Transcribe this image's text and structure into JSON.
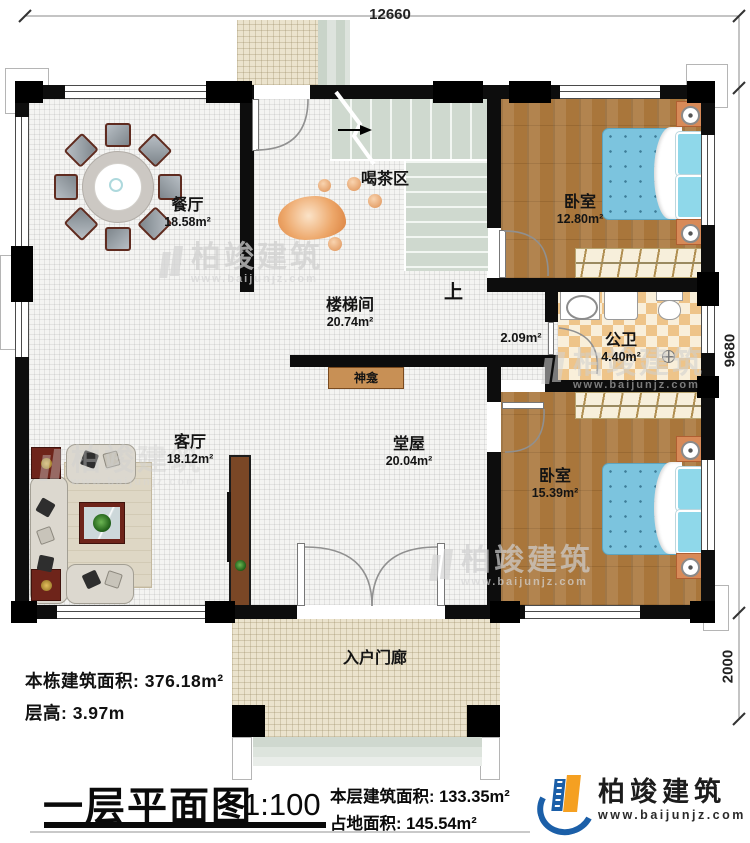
{
  "dimensions": {
    "top_width": "12660",
    "main_depth": "9680",
    "porch_depth": "2000"
  },
  "rooms": {
    "dining": {
      "label": "餐厅",
      "area": "18.58m²"
    },
    "tea_area": {
      "label": "喝茶区"
    },
    "stairwell": {
      "label": "楼梯间",
      "area": "20.74m²"
    },
    "stairs_up": {
      "label": "上"
    },
    "corridor": {
      "area": "2.09m²"
    },
    "bedroom_top": {
      "label": "卧室",
      "area": "12.80m²"
    },
    "bathroom": {
      "label": "公卫",
      "area": "4.40m²"
    },
    "living": {
      "label": "客厅",
      "area": "18.12m²"
    },
    "hall": {
      "label": "堂屋",
      "area": "20.04m²"
    },
    "shrine": {
      "label": "神龛"
    },
    "bedroom_bottom": {
      "label": "卧室",
      "area": "15.39m²"
    },
    "porch": {
      "label": "入户门廊"
    }
  },
  "notes": {
    "building_area": "本栋建筑面积: 376.18m²",
    "floor_height": "层高: 3.97m"
  },
  "titleblock": {
    "title": "一层平面图",
    "scale": "1:100",
    "floor_area": "本层建筑面积: 133.35m²",
    "footprint_area": "占地面积: 145.54m²"
  },
  "brand": {
    "name": "柏竣建筑",
    "website": "www.baijunjz.com"
  },
  "watermark": {
    "name": "柏竣建筑",
    "website": "www.baijunjz.com"
  }
}
